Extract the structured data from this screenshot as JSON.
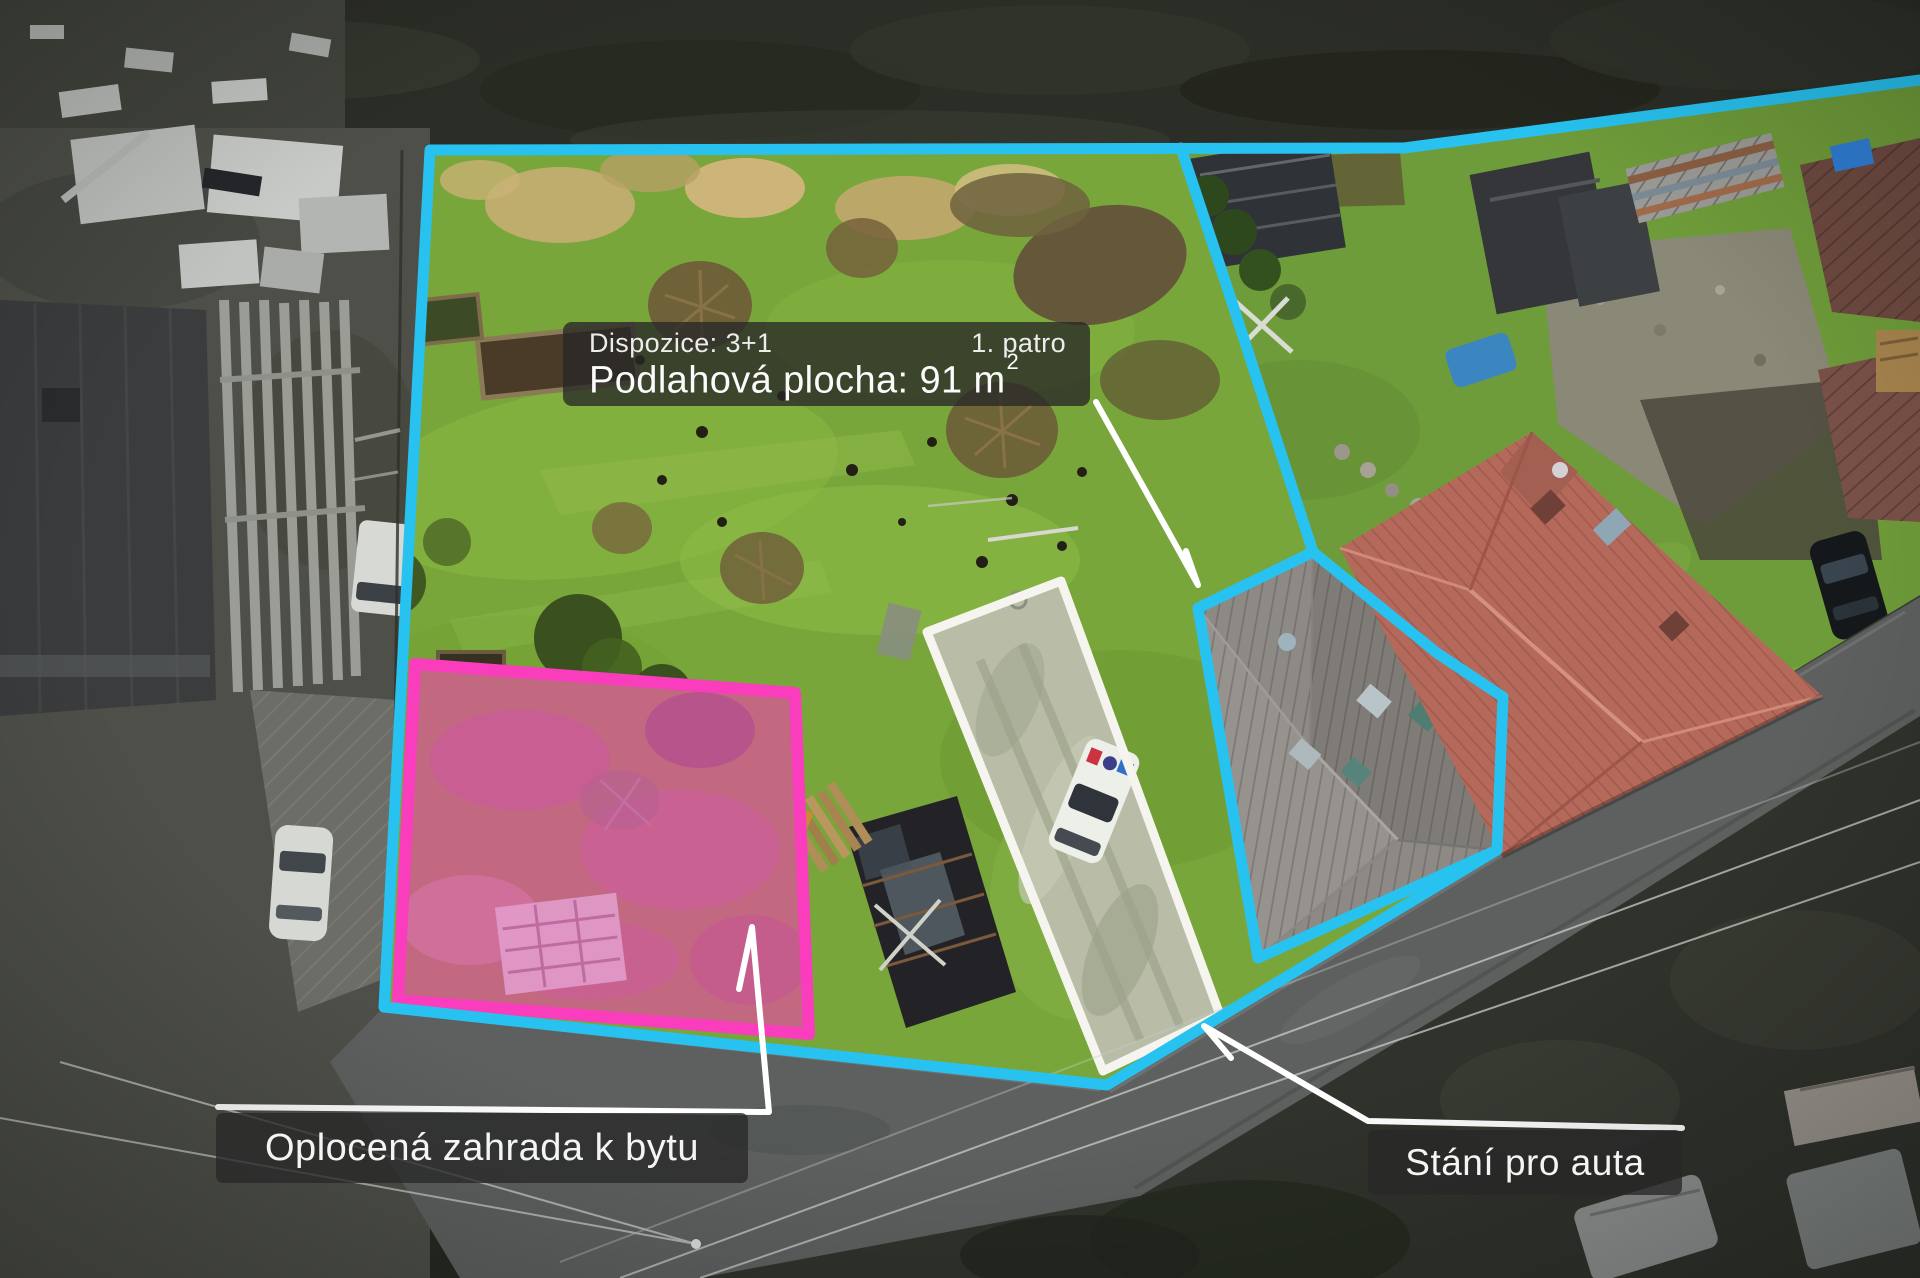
{
  "annotations": {
    "info_box": {
      "dispozice": "Dispozice: 3+1",
      "floor": "1. patro",
      "area_label": "Podlahová plocha: 91 m",
      "area_superscript": "2"
    },
    "garden_label": "Oplocená zahrada k bytu",
    "parking_label": "Stání pro auta"
  },
  "colors": {
    "property_outline": "#27c2f0",
    "garden_plot_outline": "#f93dbd",
    "garden_plot_fill": "rgba(244,62,190,0.30)",
    "parking_outline": "#f6f4ee",
    "parking_fill": "#b9bda8",
    "pointer_line": "#ffffff",
    "label_background": "rgba(40,40,40,0.78)",
    "label_text": "#f4f4f4"
  }
}
